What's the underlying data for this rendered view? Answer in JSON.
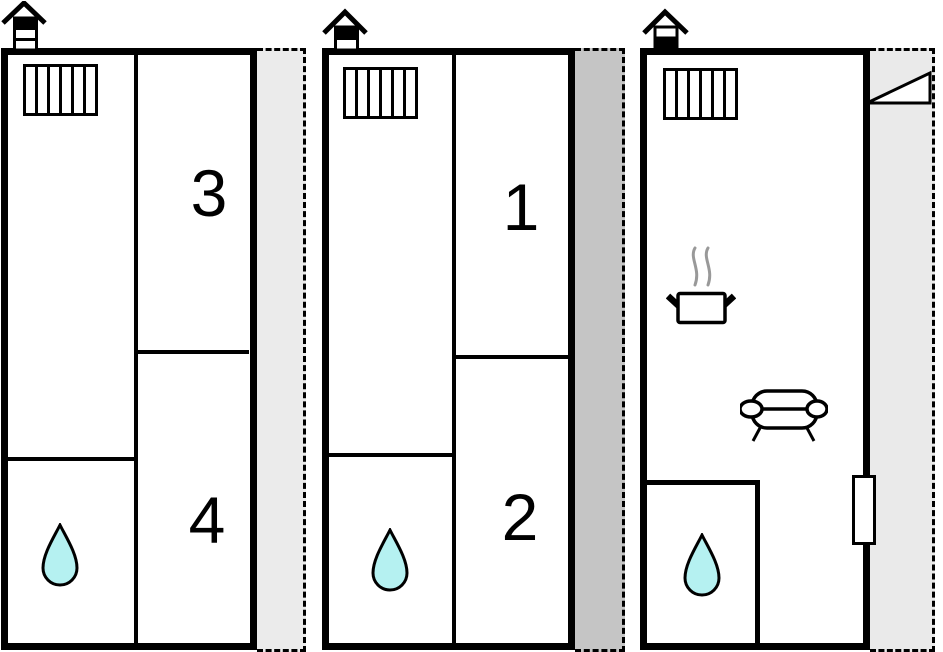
{
  "floorplan": {
    "units": [
      {
        "id": "left",
        "rooms": {
          "top": "3",
          "bottom": "4"
        },
        "icons_present": [
          "house-chimney-icon",
          "radiator-icon",
          "water-drop-icon"
        ],
        "terrace_color": "#ebebeb"
      },
      {
        "id": "middle",
        "rooms": {
          "top": "1",
          "bottom": "2"
        },
        "icons_present": [
          "house-chimney-icon",
          "radiator-icon",
          "water-drop-icon"
        ],
        "terrace_color": "#c5c5c5"
      },
      {
        "id": "right",
        "rooms": {},
        "icons_present": [
          "house-chimney-icon",
          "radiator-icon",
          "cooking-pot-icon",
          "steam-icon",
          "sofa-icon",
          "water-drop-icon",
          "door-swing-icon",
          "entrance-door"
        ],
        "terrace_color": "#eaeaea"
      }
    ],
    "colors": {
      "wall": "#000000",
      "background": "#ffffff",
      "drop_fill": "#b5f1f1",
      "steam": "#999999"
    }
  }
}
